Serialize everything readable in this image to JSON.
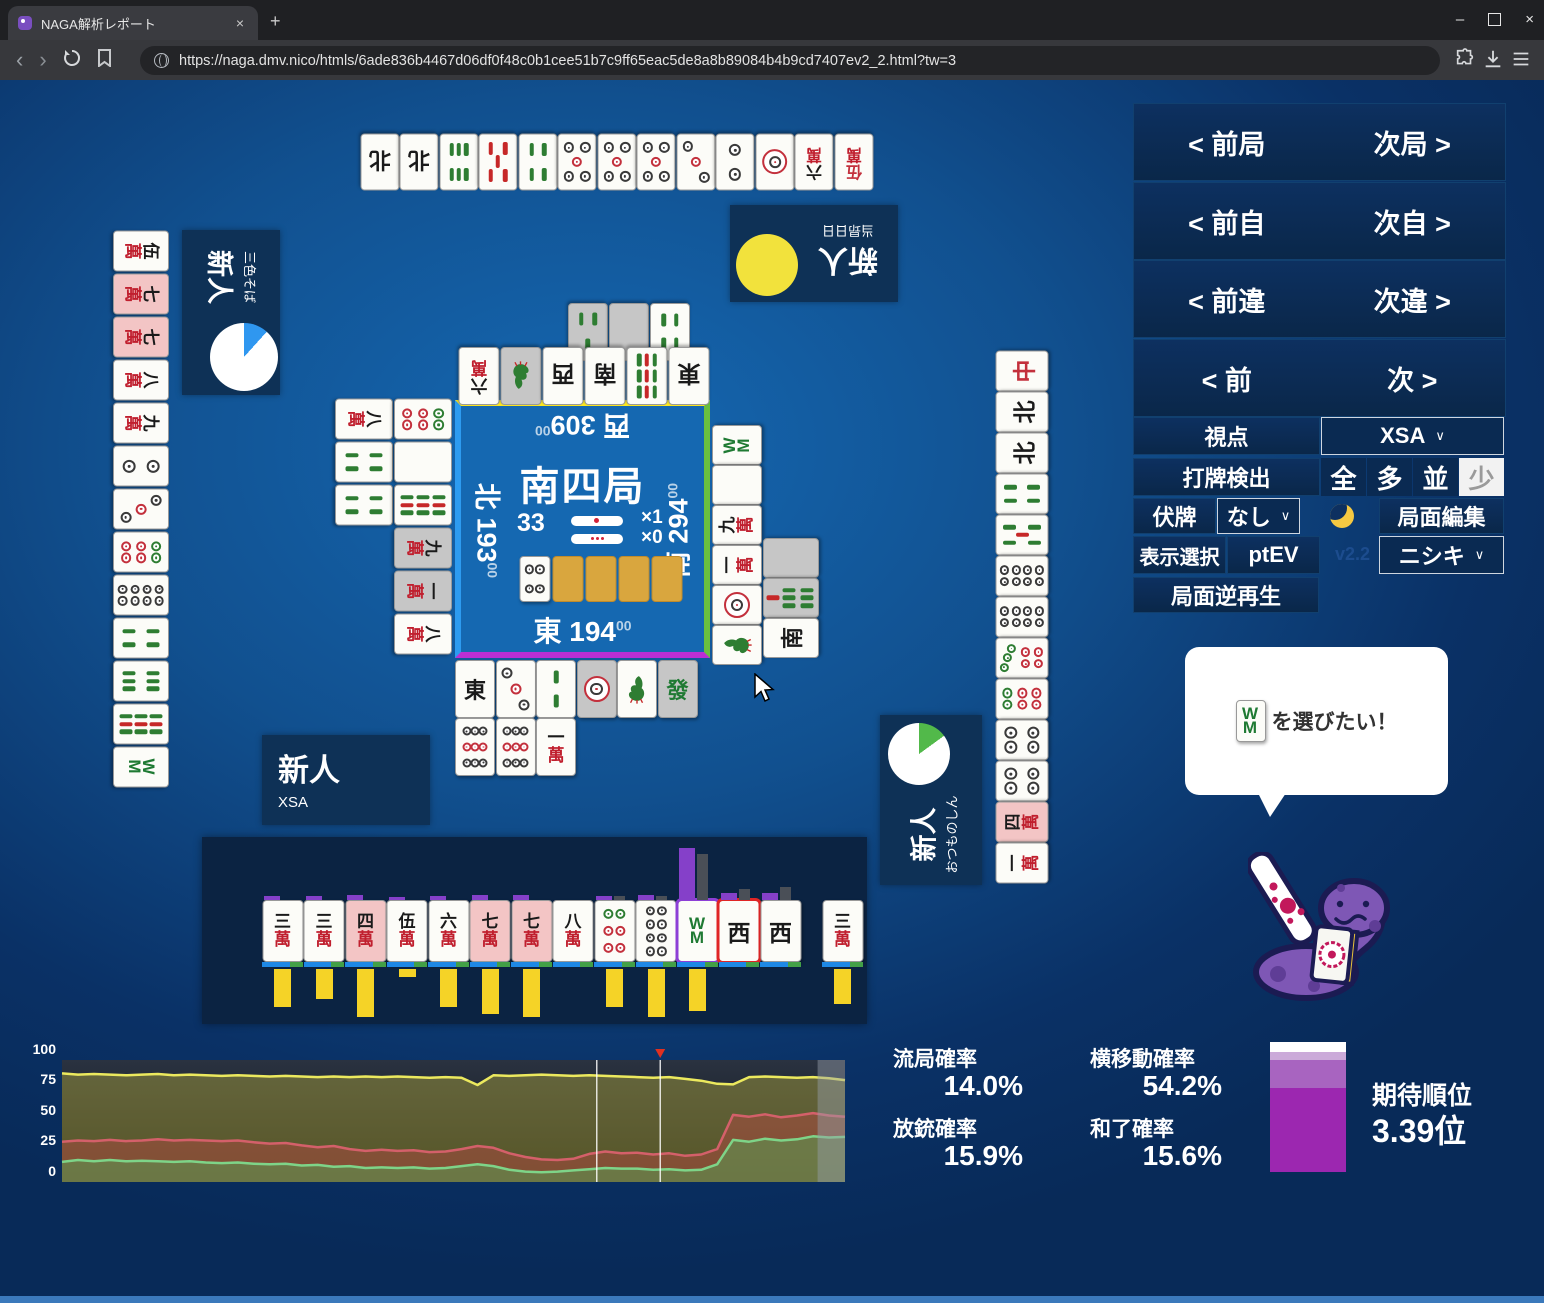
{
  "browser": {
    "tab_title": "NAGA解析レポート",
    "url": "https://naga.dmv.nico/htmls/6ade836b4467d06df0f48c0b1cee51b7c9ff65eac5de8a8b89084b4b9cd7407ev2_2.html?tw=3",
    "new_tab": "+",
    "close_tab": "×",
    "win_min": "–",
    "win_close": "×"
  },
  "nav_panel": {
    "rows": [
      {
        "left": "< 前局",
        "right": "次局 >"
      },
      {
        "left": "< 前自",
        "right": "次自 >"
      },
      {
        "left": "< 前違",
        "right": "次違 >"
      },
      {
        "left": "< 前",
        "right": "次 >"
      }
    ],
    "viewpoint_label": "視点",
    "viewpoint_value": "XSA",
    "dahai_label": "打牌検出",
    "dahai_options": [
      "全",
      "多",
      "並",
      "少"
    ],
    "dahai_selected": "少",
    "fusehai_label": "伏牌",
    "fusehai_value": "なし",
    "edit_button": "局面編集",
    "display_label": "表示選択",
    "display_value": "ptEV",
    "version": "v2.2",
    "model_value": "ニシキ",
    "reverse_button": "局面逆再生",
    "chevron": "∨"
  },
  "center": {
    "round": "南四局",
    "wall_count": "33",
    "stick_counts": [
      "×1",
      "×0"
    ],
    "score_suffix": "00",
    "seats": {
      "east": {
        "label": "東",
        "score": "194"
      },
      "south": {
        "label": "南",
        "score": "294"
      },
      "west": {
        "label": "西",
        "score": "309"
      },
      "north": {
        "label": "北",
        "score": "193"
      }
    },
    "dora_tiles": [
      "4p",
      "back",
      "back",
      "back",
      "back"
    ]
  },
  "players": {
    "top": {
      "name": "新人",
      "sub": "当昻日日",
      "disc_color": "#f2e23c"
    },
    "left": {
      "name": "新人",
      "sub": "三色そば",
      "pie_deg": 42,
      "pie_color": "#2f97f0"
    },
    "right": {
      "name": "新人",
      "sub": "おつものしん",
      "pie_deg": 54,
      "pie_color": "#52b94a"
    },
    "self": {
      "name": "新人",
      "sub": "XSA"
    }
  },
  "hands": {
    "top": [
      "N",
      "N",
      "6s",
      "0s",
      "4s",
      "5p",
      "5p",
      "5p",
      "3p",
      "2p",
      "1p",
      "6m",
      "0m"
    ],
    "left": [
      "5m",
      "7m:p",
      "7m:p",
      "8m",
      "9m",
      "2p",
      "3p",
      "6p",
      "8p",
      "4s",
      "6s",
      "9s",
      "8s"
    ],
    "right": [
      "C",
      "N",
      "N",
      "4s",
      "5s",
      "8p",
      "8p",
      "7p",
      "6p",
      "4p",
      "4p",
      "4m:p",
      "1m"
    ],
    "self": {
      "tiles": [
        {
          "c": "3m",
          "bar": 38,
          "tp": 4,
          "tg": 0
        },
        {
          "c": "3m",
          "bar": 30,
          "tp": 4,
          "tg": 0
        },
        {
          "c": "4m",
          "hl": true,
          "bar": 48,
          "tp": 5,
          "tg": 0
        },
        {
          "c": "5m",
          "bar": 8,
          "tp": 3,
          "tg": 0
        },
        {
          "c": "6m",
          "bar": 38,
          "tp": 4,
          "tg": 0
        },
        {
          "c": "7m",
          "hl": true,
          "bar": 45,
          "tp": 5,
          "tg": 0
        },
        {
          "c": "7m",
          "hl": true,
          "bar": 48,
          "tp": 5,
          "tg": 0
        },
        {
          "c": "8m",
          "bar": 0,
          "tp": 0,
          "tg": 0
        },
        {
          "c": "6p",
          "bar": 38,
          "tp": 4,
          "tg": 4
        },
        {
          "c": "8p",
          "bar": 48,
          "tp": 5,
          "tg": 4
        },
        {
          "c": "8s",
          "sel": "naga",
          "bar": 42,
          "tp": 52,
          "tg": 46
        },
        {
          "c": "W",
          "sel": "real",
          "bar": 0,
          "tp": 7,
          "tg": 11
        },
        {
          "c": "W",
          "bar": 0,
          "tp": 7,
          "tg": 13
        }
      ],
      "drawn": {
        "c": "3m",
        "bar": 35,
        "tp": 0,
        "tg": 0
      }
    }
  },
  "discards": {
    "top_row1": [
      "3s:g",
      "blankG",
      "4s"
    ],
    "top_row2": [
      "6m",
      "1s:g",
      "W",
      "S",
      "9s",
      "E"
    ],
    "left_outer": [
      "8m",
      "4s",
      "4s"
    ],
    "left_inner": [
      "6p",
      "blankW",
      "9s",
      "9m:g",
      "1m:g",
      "8m"
    ],
    "bottom_row1": [
      "E",
      "3p",
      "2s",
      "1p:g",
      "1s",
      "F:g"
    ],
    "bottom_row2": [
      "9p",
      "9p",
      "1m"
    ],
    "right_inner": [
      "8s",
      "blankW",
      "9m",
      "1m",
      "1p",
      "1s"
    ],
    "right_outer": [
      "blankG",
      "7s:g",
      "S"
    ]
  },
  "bubble": {
    "tile": "8s",
    "text": "を選びたい！"
  },
  "stats": {
    "ryukyoku": {
      "label": "流局確率",
      "value": "14.0%"
    },
    "yokoido": {
      "label": "横移動確率",
      "value": "54.2%"
    },
    "hoju": {
      "label": "放銃確率",
      "value": "15.9%"
    },
    "hora": {
      "label": "和了確率",
      "value": "15.6%"
    },
    "rank": {
      "label": "期待順位",
      "value": "3.39位",
      "segments": [
        {
          "color": "#ffffff",
          "h": 10
        },
        {
          "color": "#cbaad9",
          "h": 8
        },
        {
          "color": "#a864c0",
          "h": 28
        },
        {
          "color": "#9c27b0",
          "h": 84
        }
      ]
    }
  },
  "chart_data": {
    "type": "line",
    "title": "",
    "xlabel": "",
    "ylabel": "",
    "ylim": [
      0,
      100
    ],
    "yticks": [
      "100",
      "75",
      "50",
      "25",
      "0"
    ],
    "grid": false,
    "legend": "none",
    "marker_x_fraction": 0.764,
    "cursor_lines_fraction": [
      0.683,
      0.764
    ],
    "future_overlay_from_fraction": 0.965,
    "series": [
      {
        "name": "yellow",
        "color": "#ece95e",
        "fill": "rgba(200,190,60,0.38)",
        "values": [
          89,
          88,
          88.5,
          88,
          87.5,
          88,
          88.5,
          87.5,
          88,
          87.5,
          87,
          87.5,
          87,
          86.5,
          87,
          86.5,
          86,
          86.5,
          86,
          86.5,
          86,
          86.5,
          86,
          85.5,
          86,
          85.5,
          79.5,
          87.5,
          87,
          87.5,
          88,
          87.5,
          87,
          87.5,
          87,
          86.5,
          86,
          85.5,
          86,
          84.5,
          83,
          80.5,
          80,
          86,
          86.5,
          86,
          85.5,
          86,
          85,
          83.5
        ]
      },
      {
        "name": "red",
        "color": "#d4606a",
        "fill": "rgba(190,70,70,0.42)",
        "values": [
          33,
          34,
          33.5,
          34.5,
          33.5,
          34,
          35,
          34,
          34.5,
          34,
          33.5,
          34,
          32.5,
          31.5,
          32,
          30,
          28.5,
          29.5,
          27,
          25.5,
          26.5,
          25.5,
          26,
          24.5,
          25,
          27,
          29.5,
          28,
          23.5,
          20.5,
          18.5,
          18,
          19,
          23,
          25,
          23.5,
          24,
          22.5,
          23.5,
          21.5,
          22.5,
          27,
          55,
          53.5,
          55.5,
          53,
          54.5,
          56.5,
          54.5,
          53.5
        ]
      },
      {
        "name": "green",
        "color": "#7ed488",
        "fill": "rgba(80,170,90,0.45)",
        "values": [
          16.5,
          18,
          17,
          18,
          17,
          17.5,
          17,
          16.5,
          17,
          16,
          15.5,
          16,
          15,
          14.5,
          15,
          13.5,
          14,
          12.5,
          13,
          11.5,
          12,
          11.5,
          12,
          11,
          11.5,
          13,
          14.5,
          13,
          10,
          8.5,
          8,
          8.5,
          9.5,
          10.5,
          11.5,
          11,
          11,
          10,
          10.5,
          9.5,
          10,
          14.5,
          34.5,
          33,
          35.5,
          34,
          35,
          37.5,
          36.5,
          37
        ]
      }
    ]
  }
}
